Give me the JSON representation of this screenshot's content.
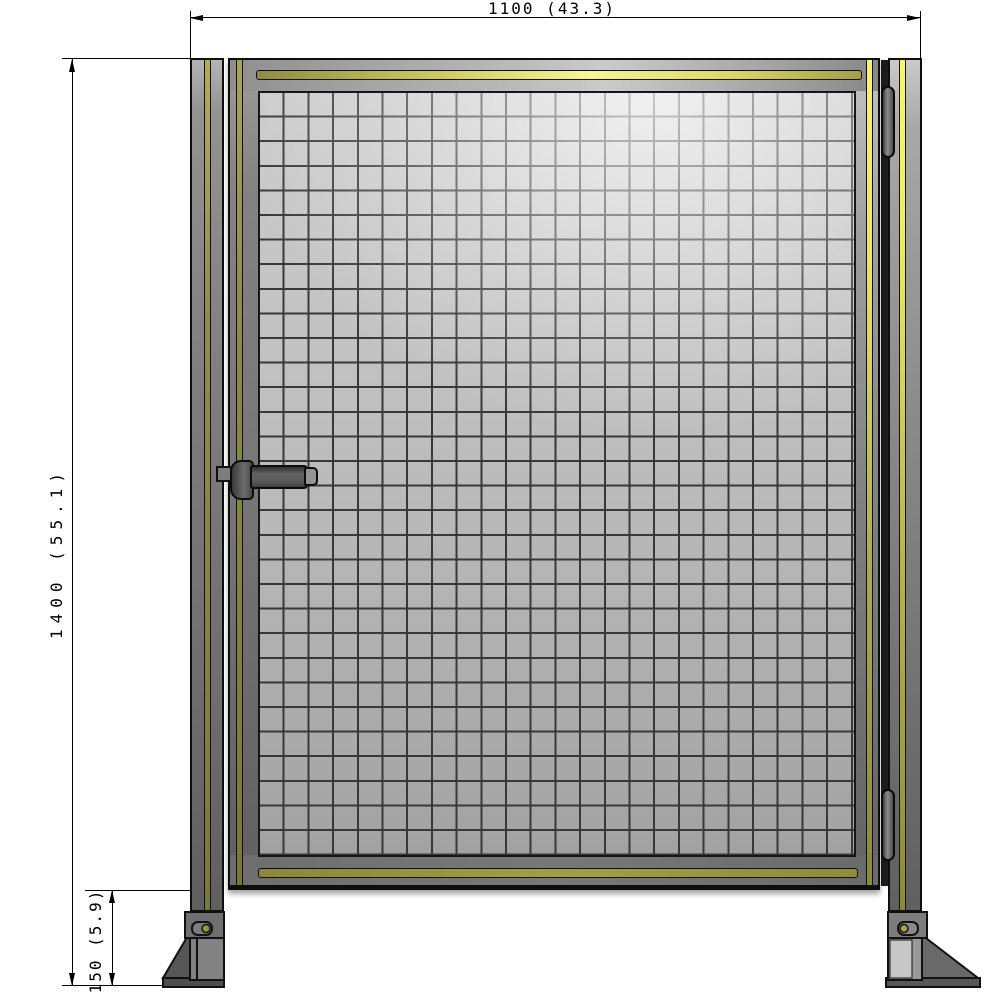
{
  "drawing": {
    "dimension_width": {
      "label": "1100 (43.3)"
    },
    "dimension_height": {
      "label": "1400 (55.1)"
    },
    "dimension_clearance": {
      "label": "150 (5.9)"
    }
  },
  "colors": {
    "safety_stripe_yellow_bright": "#f2ef6a",
    "safety_stripe_olive": "#8b883c",
    "frame_gray": "#7a7a7a",
    "mesh_fill_light": "#cdcdcd",
    "mesh_fill_dark": "#a5a5a5",
    "mesh_wire": "#383838",
    "outline": "#111111",
    "dimension_line": "#000000",
    "background": "#ffffff"
  },
  "mesh": {
    "columns": 24,
    "rows": 31
  }
}
